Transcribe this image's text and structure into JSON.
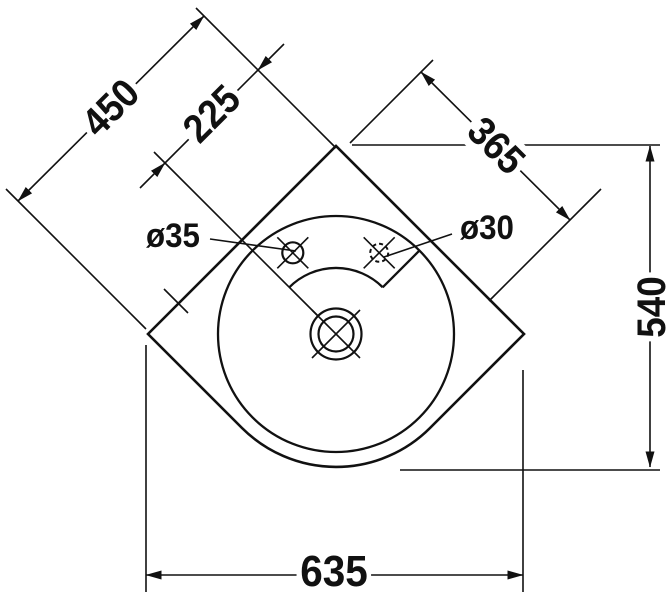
{
  "drawing": {
    "title": "corner-washbasin-plan-technical-drawing",
    "units": "mm",
    "labels": {
      "side_length": "450",
      "hole_centerline_offset": "225",
      "deck_diagonal": "365",
      "depth": "540",
      "front_width": "635",
      "tap_hole_left": "ø35",
      "tap_hole_right": "ø30"
    },
    "colors": {
      "line": "#111111",
      "background": "#ffffff"
    }
  }
}
